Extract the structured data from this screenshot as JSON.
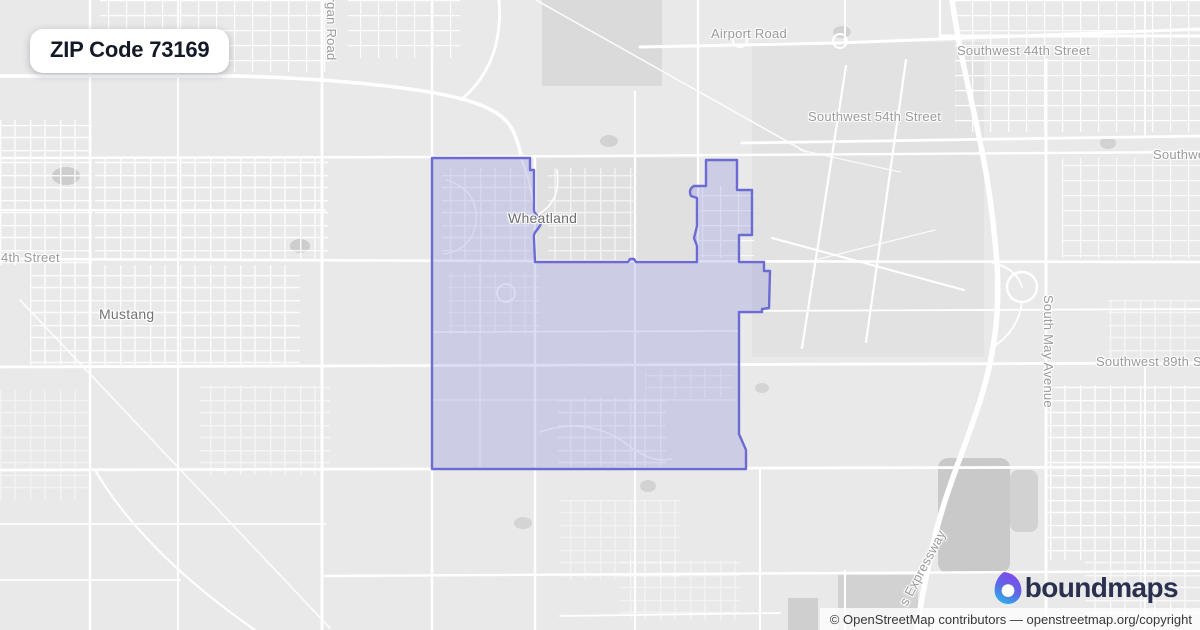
{
  "badge": {
    "title": "ZIP Code 73169"
  },
  "map": {
    "labels": {
      "airport_road": "Airport Road",
      "sw_44th": "Southwest 44th Street",
      "sw_54th": "Southwest 54th Street",
      "sw_right_cut": "Southwest",
      "street_4th": "4th Street",
      "sw_89th": "Southwest 89th Street",
      "mustang": "Mustang",
      "wheatland": "Wheatland",
      "morgan_road": "Morgan Road",
      "south_may": "South May Avenue",
      "expressway": "s Expressway"
    },
    "zip_boundary": {
      "zip": "73169",
      "stroke_color": "#6c6bd3",
      "fill_color": "rgba(126,130,217,0.27)"
    }
  },
  "logo": {
    "text": "boundmaps",
    "icon": "boundmaps-pin-icon",
    "colors": {
      "purple": "#8148e8",
      "cyan": "#27b7e9",
      "navy": "#2a3050"
    }
  },
  "attribution": {
    "text": "© OpenStreetMap contributors — openstreetmap.org/copyright"
  }
}
